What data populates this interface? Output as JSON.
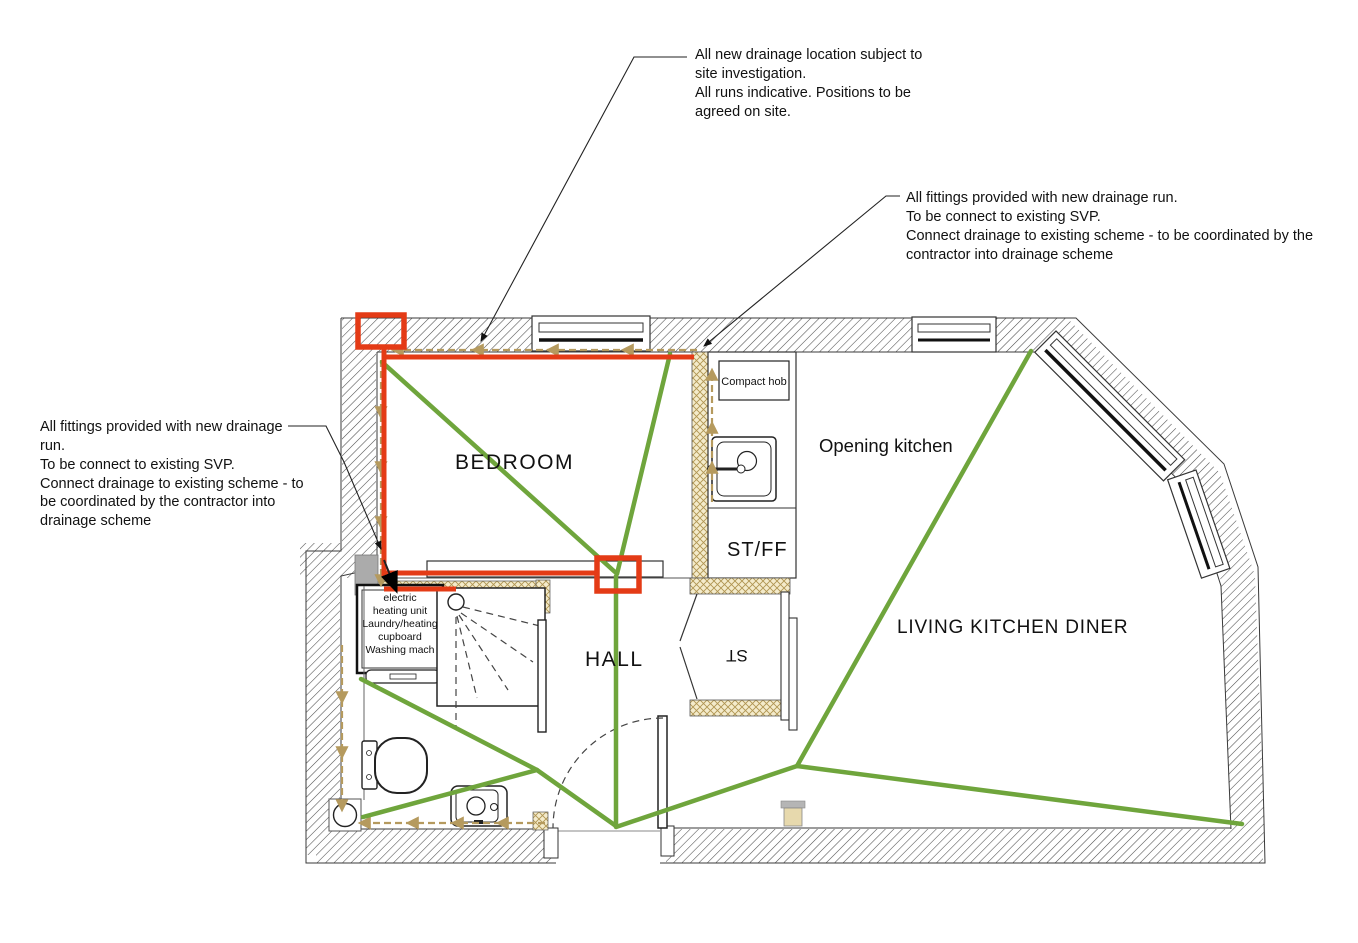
{
  "annotations": {
    "top": {
      "text": "All new drainage location subject to\nsite investigation.\nAll runs indicative. Positions to be\nagreed on site."
    },
    "right": {
      "text": "All fittings provided with new drainage run.\nTo be connect to existing SVP.\nConnect drainage to existing scheme - to be coordinated by the\ncontractor into drainage scheme"
    },
    "left": {
      "text": "All fittings provided with new drainage\nrun.\nTo be connect to existing SVP.\nConnect drainage to existing scheme - to\nbe coordinated by the contractor into\ndrainage scheme"
    }
  },
  "room_labels": {
    "bedroom": "BEDROOM",
    "hall": "HALL",
    "st_ff": "ST/FF",
    "st": "ST",
    "opening_kitchen": "Opening kitchen",
    "living_kitchen_diner": "LIVING KITCHEN DINER"
  },
  "fixture_labels": {
    "compact_hob": "Compact hob",
    "heating_cupboard_lines": [
      "electric",
      "heating unit",
      "Laundry/heating",
      "cupboard",
      "Washing mach"
    ]
  },
  "colors": {
    "new_drainage_red": "#e43b16",
    "services_green": "#6fa53c",
    "drainage_run_tan": "#b59a5e"
  }
}
